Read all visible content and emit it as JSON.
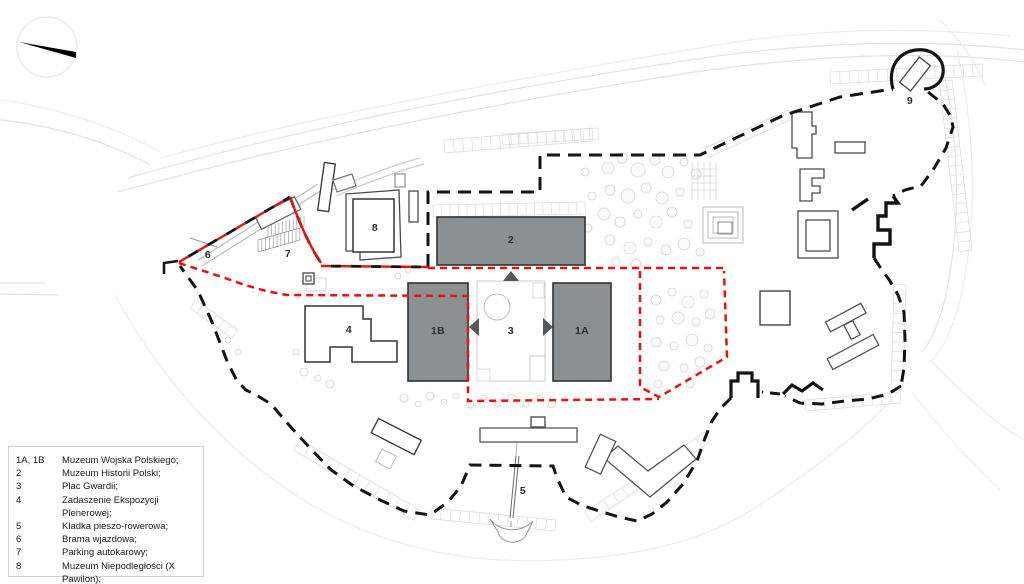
{
  "page": {
    "type": "architectural site plan",
    "background": "#ffffff"
  },
  "compass": {
    "icon": "north-arrow"
  },
  "plan_labels": {
    "b2": "2",
    "b1b": "1B",
    "b1a": "1A",
    "plaza": "3",
    "canopy": "4",
    "bridge": "5",
    "gate": "6",
    "parking": "7",
    "pavilion": "8",
    "katyn": "9"
  },
  "legend": {
    "items": [
      {
        "key": "1A, 1B",
        "label": "Muzeum Wojska Polskiego;"
      },
      {
        "key": "2",
        "label": "Muzeum Historii Polski;"
      },
      {
        "key": "3",
        "label": "Plac Gwardii;"
      },
      {
        "key": "4",
        "label": "Zadaszenie Ekspozycji Plenerowej;"
      },
      {
        "key": "5",
        "label": "Kładka pieszo-rowerowa;"
      },
      {
        "key": "6",
        "label": "Brama wjazdowa;"
      },
      {
        "key": "7",
        "label": "Parking autokarowy;"
      },
      {
        "key": "8",
        "label": "Muzeum Niepodległości (X Pawilon);"
      },
      {
        "key": "9",
        "label": "Muzeum Katyńskie."
      }
    ]
  },
  "colors": {
    "boundary_red": "#e8120b",
    "boundary_black": "#141414",
    "building_fill": "#8d9093",
    "building_stroke": "#2f3133",
    "light_detail": "#dedede",
    "label_text": "#2d2d2f"
  }
}
